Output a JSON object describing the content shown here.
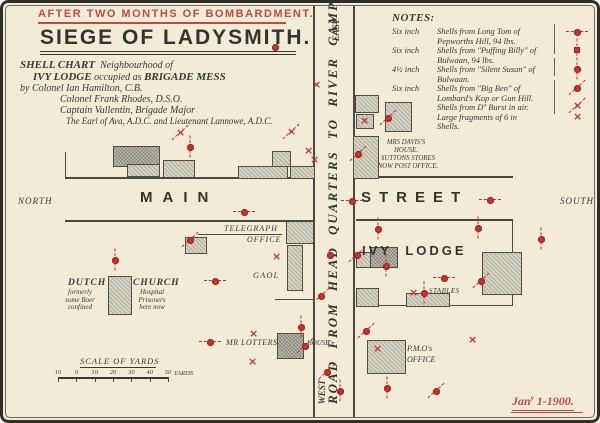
{
  "banner": "AFTER TWO MONTHS OF BOMBARDMENT.",
  "title": "SIEGE OF LADYSMITH.",
  "subtitle": {
    "shell_chart": "SHELL CHART",
    "neighbourhood": "Neighbourhood of",
    "ivy_lodge": "IVY LODGE",
    "occupied": "occupied as",
    "brigade_mess": "BRIGADE MESS",
    "credit1": "by Colonel Ian Hamilton, C.B.",
    "credit2": "Colonel Frank Rhodes, D.S.O.",
    "credit3": "Captain Vallentin, Brigade Major",
    "credit4": "The Earl of Ava, A.D.C. and Lieutenant Lannowe, A.D.C."
  },
  "notes": {
    "heading": "NOTES:",
    "items": [
      {
        "size": "Six inch",
        "desc": "Shells from Long Tom of Pepworths Hill, 94 lbs."
      },
      {
        "size": "Six inch",
        "desc": "Shells from \"Puffing Billy\" of Bulwaan, 94 lbs."
      },
      {
        "size": "4½ inch",
        "desc": "Shells from \"Silent Susan\" of Bulwaan."
      },
      {
        "size": "Six inch",
        "desc": "Shells from \"Big Ben\" of Lombard's Kop or Gun Hill."
      },
      {
        "size": "",
        "desc": "Shells from Dº Burst in air. Large fragments of 6 in Shells."
      }
    ],
    "symbols": [
      {
        "t": "dot-h",
        "y": 32
      },
      {
        "t": "square-v",
        "y": 50
      },
      {
        "t": "dot-v",
        "y": 69
      },
      {
        "t": "dot-d",
        "y": 88
      },
      {
        "t": "cross-d",
        "y": 106
      },
      {
        "t": "cross",
        "y": 117
      }
    ]
  },
  "compass": {
    "north": "NORTH",
    "south": "SOUTH",
    "east": "EAST",
    "west": "WEST"
  },
  "streets": {
    "main_west": "MAIN",
    "main_east": "STREET",
    "road": "ROAD FROM HEAD QUARTERS TO RIVER CAMPS"
  },
  "places": {
    "ivy_lodge": "IVY LODGE",
    "telegraph1": "TELEGRAPH",
    "telegraph2": "OFFICE",
    "gaol": "GAOL",
    "dutch": "DUTCH",
    "church": "CHURCH",
    "dutch_note": [
      "formerly",
      "some Boer",
      "confined"
    ],
    "church_note": [
      "Hospital",
      "Prisoners",
      "here now"
    ],
    "davis": [
      "MRS DAVIS'S",
      "HOUSE."
    ],
    "suttons": [
      "SUTTONS STORES",
      "NOW POST OFFICE."
    ],
    "lotters": "MR LOTTERS",
    "house": "HOUSE",
    "stables": "STABLES",
    "pmo1": "P.M.O's",
    "pmo2": "OFFICE"
  },
  "scale": {
    "title": "SCALE OF YARDS",
    "ticks": [
      "10",
      "0",
      "10",
      "20",
      "30",
      "40",
      "50"
    ],
    "unit": "YARDS"
  },
  "date": {
    "main": "Jan",
    "sup": "y",
    "rest": " 1-1900."
  },
  "colors": {
    "red": "#c5342c",
    "ink": "#3a3933",
    "paper": "#f2ebd8"
  },
  "map": {
    "lines": [
      {
        "x": 65,
        "y": 152,
        "len": 27,
        "dir": "v",
        "w": 1
      },
      {
        "x": 65,
        "y": 177,
        "len": 249,
        "dir": "h",
        "w": 2
      },
      {
        "x": 356,
        "y": 176,
        "len": 157,
        "dir": "h",
        "w": 2
      },
      {
        "x": 65,
        "y": 220,
        "len": 249,
        "dir": "h",
        "w": 2
      },
      {
        "x": 356,
        "y": 219,
        "len": 157,
        "dir": "h",
        "w": 2
      },
      {
        "x": 313,
        "y": 5,
        "len": 412,
        "dir": "v",
        "w": 2
      },
      {
        "x": 353,
        "y": 5,
        "len": 412,
        "dir": "v",
        "w": 2
      },
      {
        "x": 512,
        "y": 219,
        "len": 87,
        "dir": "v",
        "w": 1
      },
      {
        "x": 356,
        "y": 305,
        "len": 157,
        "dir": "h",
        "w": 1
      },
      {
        "x": 198,
        "y": 234,
        "len": 84,
        "dir": "h",
        "w": 1
      },
      {
        "x": 275,
        "y": 299,
        "len": 39,
        "dir": "h",
        "w": 1
      },
      {
        "x": 554,
        "y": 24,
        "len": 30,
        "dir": "v",
        "w": 1,
        "c": "#6b675c"
      },
      {
        "x": 554,
        "y": 58,
        "len": 18,
        "dir": "v",
        "w": 1,
        "c": "#6b675c"
      },
      {
        "x": 554,
        "y": 80,
        "len": 34,
        "dir": "v",
        "w": 1,
        "c": "#6b675c"
      }
    ],
    "buildings": [
      {
        "x": 113,
        "y": 146,
        "w": 45,
        "h": 19,
        "dark": true
      },
      {
        "x": 127,
        "y": 164,
        "w": 31,
        "h": 11
      },
      {
        "x": 163,
        "y": 160,
        "w": 30,
        "h": 16
      },
      {
        "x": 272,
        "y": 151,
        "w": 17,
        "h": 14
      },
      {
        "x": 238,
        "y": 166,
        "w": 48,
        "h": 11
      },
      {
        "x": 290,
        "y": 166,
        "w": 23,
        "h": 11
      },
      {
        "x": 355,
        "y": 95,
        "w": 22,
        "h": 16
      },
      {
        "x": 356,
        "y": 114,
        "w": 16,
        "h": 13
      },
      {
        "x": 385,
        "y": 102,
        "w": 25,
        "h": 28
      },
      {
        "x": 353,
        "y": 136,
        "w": 24,
        "h": 41
      },
      {
        "x": 286,
        "y": 221,
        "w": 26,
        "h": 21
      },
      {
        "x": 287,
        "y": 245,
        "w": 14,
        "h": 44
      },
      {
        "x": 185,
        "y": 237,
        "w": 20,
        "h": 15
      },
      {
        "x": 108,
        "y": 276,
        "w": 22,
        "h": 37
      },
      {
        "x": 277,
        "y": 333,
        "w": 25,
        "h": 24,
        "dark": true
      },
      {
        "x": 370,
        "y": 247,
        "w": 26,
        "h": 19,
        "dark": true
      },
      {
        "x": 356,
        "y": 252,
        "w": 13,
        "h": 14
      },
      {
        "x": 356,
        "y": 288,
        "w": 21,
        "h": 17
      },
      {
        "x": 406,
        "y": 293,
        "w": 42,
        "h": 12
      },
      {
        "x": 482,
        "y": 252,
        "w": 38,
        "h": 41
      },
      {
        "x": 367,
        "y": 340,
        "w": 37,
        "h": 32
      }
    ],
    "markers": [
      {
        "t": "cross-d",
        "x": 180,
        "y": 133
      },
      {
        "t": "dot-v",
        "x": 190,
        "y": 147
      },
      {
        "t": "dot",
        "x": 275,
        "y": 47
      },
      {
        "t": "cross-d",
        "x": 291,
        "y": 132
      },
      {
        "t": "cross",
        "x": 308,
        "y": 151
      },
      {
        "t": "cross",
        "x": 314,
        "y": 160
      },
      {
        "t": "cross",
        "x": 316,
        "y": 85
      },
      {
        "t": "dot-h",
        "x": 244,
        "y": 212
      },
      {
        "t": "dot-h",
        "x": 352,
        "y": 201
      },
      {
        "t": "dot-h",
        "x": 490,
        "y": 200
      },
      {
        "t": "dot-v",
        "x": 115,
        "y": 260
      },
      {
        "t": "dot-d",
        "x": 190,
        "y": 240
      },
      {
        "t": "cross",
        "x": 276,
        "y": 257
      },
      {
        "t": "dot-h",
        "x": 215,
        "y": 281
      },
      {
        "t": "dot-d",
        "x": 321,
        "y": 296
      },
      {
        "t": "dot",
        "x": 330,
        "y": 255
      },
      {
        "t": "dot-h",
        "x": 210,
        "y": 342
      },
      {
        "t": "cross",
        "x": 253,
        "y": 334
      },
      {
        "t": "cross",
        "x": 252,
        "y": 362
      },
      {
        "t": "dot-v",
        "x": 301,
        "y": 327
      },
      {
        "t": "dot-d",
        "x": 305,
        "y": 346
      },
      {
        "t": "dot-d",
        "x": 327,
        "y": 372
      },
      {
        "t": "dot-v",
        "x": 340,
        "y": 391
      },
      {
        "t": "cross",
        "x": 364,
        "y": 121
      },
      {
        "t": "dot-d",
        "x": 388,
        "y": 118
      },
      {
        "t": "dot-d",
        "x": 358,
        "y": 154
      },
      {
        "t": "dot-v",
        "x": 378,
        "y": 229
      },
      {
        "t": "dot-d",
        "x": 357,
        "y": 255
      },
      {
        "t": "dot-v",
        "x": 386,
        "y": 266
      },
      {
        "t": "dot-h",
        "x": 444,
        "y": 278
      },
      {
        "t": "cross",
        "x": 413,
        "y": 293
      },
      {
        "t": "dot-v",
        "x": 424,
        "y": 293
      },
      {
        "t": "dot-v",
        "x": 478,
        "y": 228
      },
      {
        "t": "dot-d",
        "x": 481,
        "y": 281
      },
      {
        "t": "dot-v",
        "x": 541,
        "y": 239
      },
      {
        "t": "cross",
        "x": 472,
        "y": 340
      },
      {
        "t": "dot-d",
        "x": 366,
        "y": 331
      },
      {
        "t": "cross",
        "x": 377,
        "y": 349
      },
      {
        "t": "dot-v",
        "x": 387,
        "y": 388
      },
      {
        "t": "dot-d",
        "x": 436,
        "y": 391
      }
    ]
  }
}
